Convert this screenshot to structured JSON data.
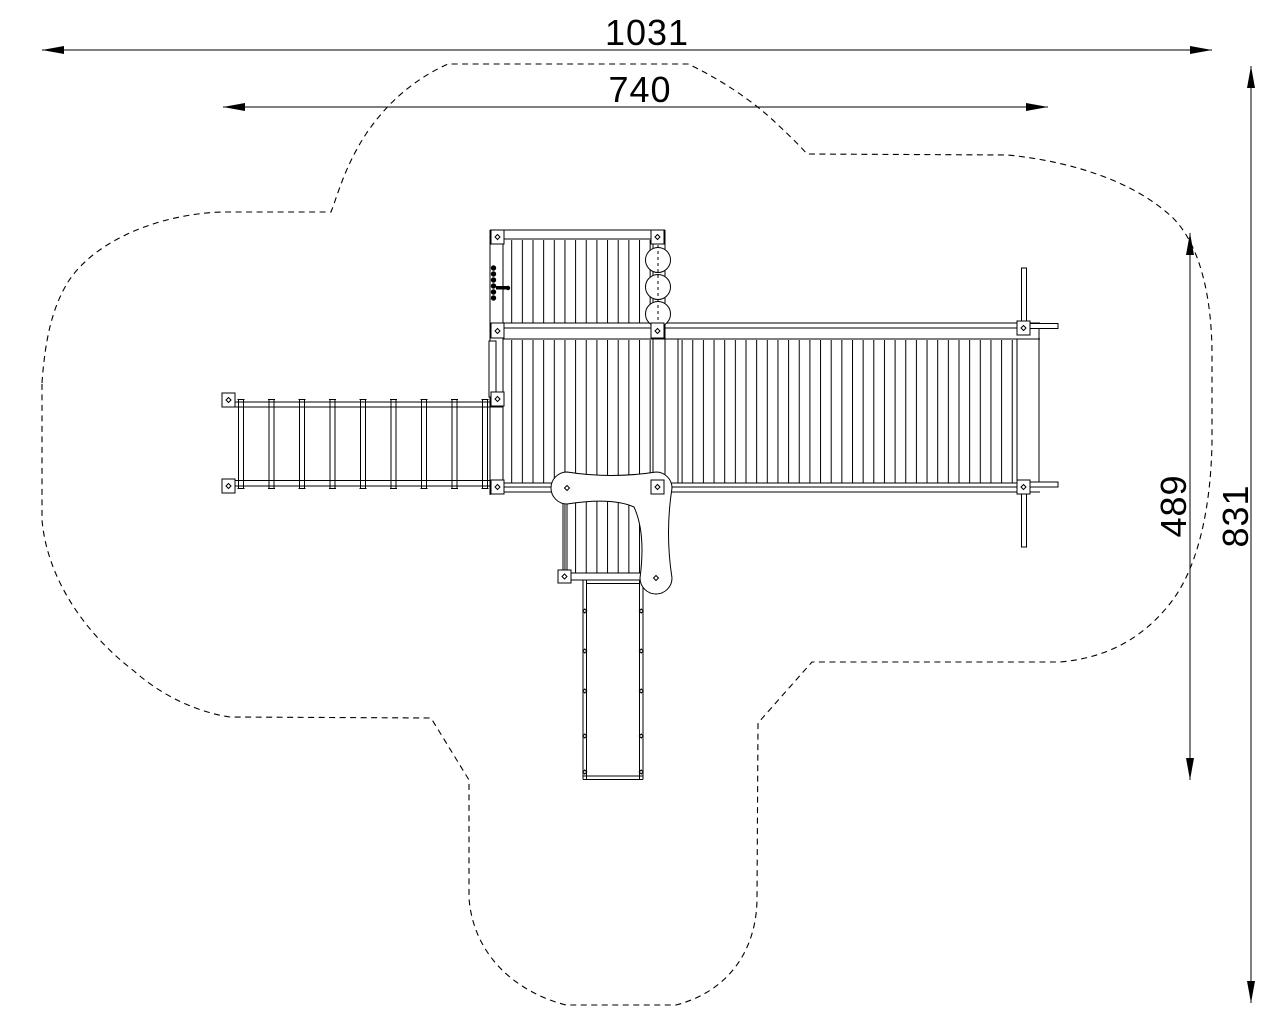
{
  "dimensions": {
    "total_width": "1031",
    "inner_width": "740",
    "inner_height": "489",
    "total_height": "831"
  },
  "colors": {
    "line": "#000000",
    "background": "#ffffff"
  },
  "components": [
    "safety-zone-outline",
    "tower-deck",
    "monkey-bar-bridge",
    "right-deck",
    "small-deck",
    "slide",
    "climbing-trilobe",
    "grip-stones",
    "steering-wheel",
    "support-bars"
  ]
}
